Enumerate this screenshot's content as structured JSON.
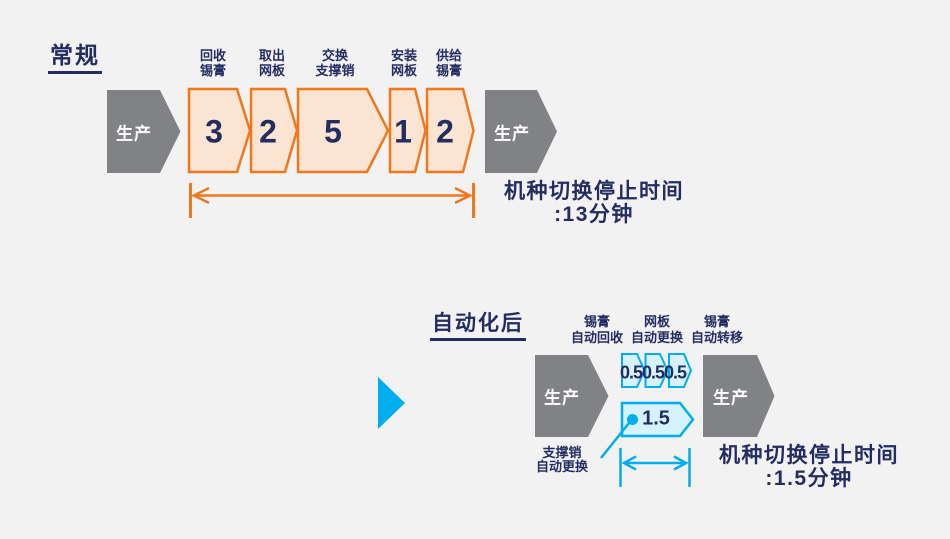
{
  "colors": {
    "background": "#F2F2F2",
    "navy_text": "#232D61",
    "orange_stroke": "#F1771D",
    "orange_fill": "#FBE4D1",
    "gray_shape": "#808285",
    "cyan_stroke": "#00AEEF",
    "cyan_fill": "#D6F2FC",
    "white_text": "#FFFFFF"
  },
  "conventional": {
    "title": "常规",
    "production_left": "生产",
    "production_right": "生产",
    "steps": [
      {
        "label_line1": "回收",
        "label_line2": "锡膏",
        "duration": "3"
      },
      {
        "label_line1": "取出",
        "label_line2": "网板",
        "duration": "2"
      },
      {
        "label_line1": "交换",
        "label_line2": "支撑销",
        "duration": "5"
      },
      {
        "label_line1": "安装",
        "label_line2": "网板",
        "duration": "1"
      },
      {
        "label_line1": "供给",
        "label_line2": "锡膏",
        "duration": "2"
      }
    ],
    "result_line1": "机种切换停止时间",
    "result_line2": ":13分钟"
  },
  "automated": {
    "title": "自动化后",
    "production_left": "生产",
    "production_right": "生产",
    "auto_steps": [
      {
        "label_line1": "锡膏",
        "label_line2": "自动回收",
        "duration": "0.5"
      },
      {
        "label_line1": "网板",
        "label_line2": "自动更换",
        "duration": "0.5"
      },
      {
        "label_line1": "锡膏",
        "label_line2": "自动转移",
        "duration": "0.5"
      }
    ],
    "support_pin": {
      "label_line1": "支撑销",
      "label_line2": "自动更换",
      "duration": "1.5"
    },
    "result_line1": "机种切换停止时间",
    "result_line2": ":1.5分钟"
  }
}
